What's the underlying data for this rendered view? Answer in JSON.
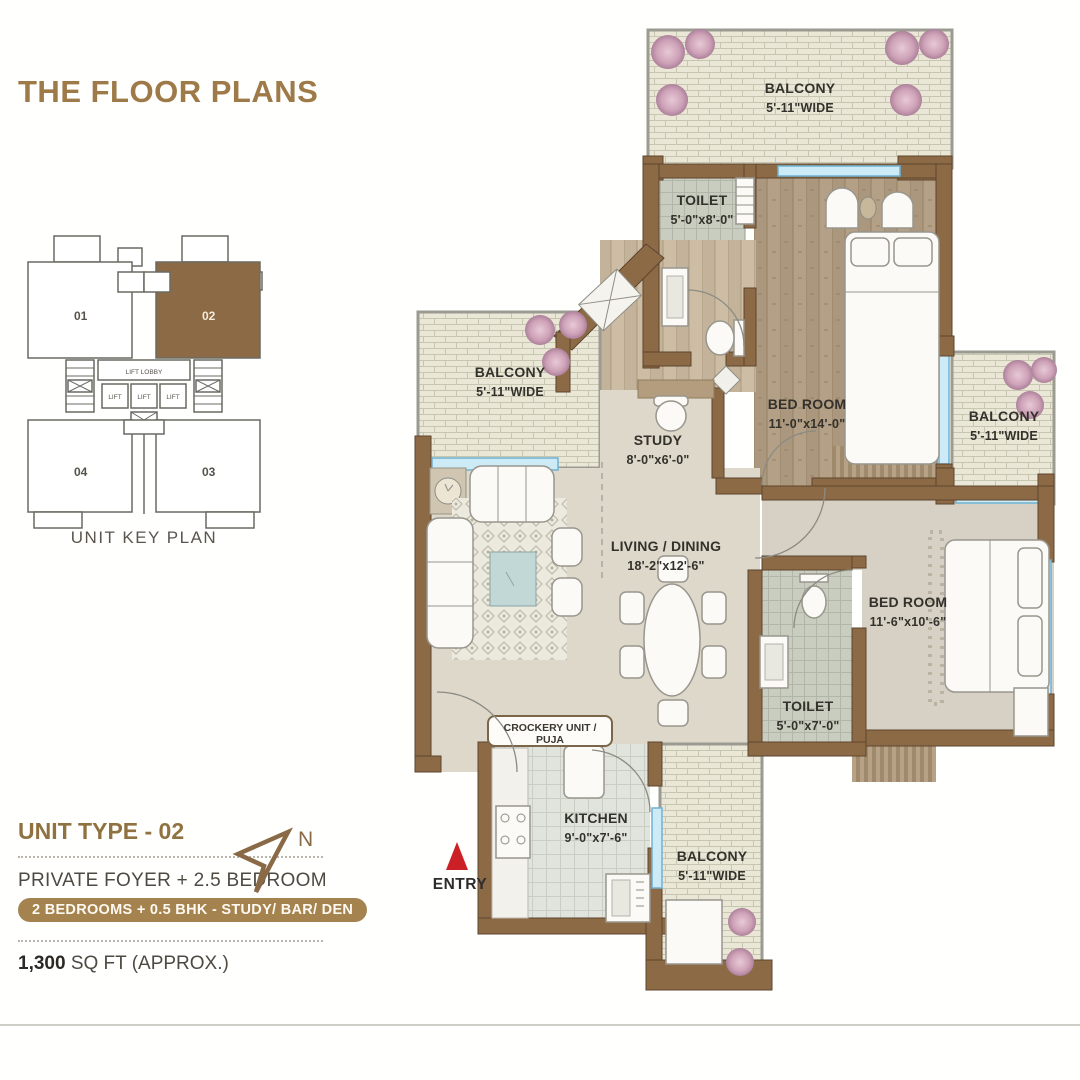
{
  "page": {
    "title": "THE FLOOR PLANS",
    "key_plan_caption": "UNIT KEY PLAN",
    "unit_type": "UNIT TYPE - 02",
    "subtitle": "PRIVATE FOYER + 2.5 BEDROOM",
    "badge": "2 BEDROOMS + 0.5 BHK - STUDY/ BAR/ DEN",
    "area_value": "1,300",
    "area_suffix": " SQ FT (APPROX.)",
    "north_label": "N",
    "entry_label": "ENTRY"
  },
  "key_plan": {
    "u1": "01",
    "u2": "02",
    "u3": "03",
    "u4": "04",
    "lift_lobby": "LIFT LOBBY",
    "lift": "LIFT",
    "highlighted_unit": "02"
  },
  "rooms": [
    {
      "name": "BALCONY",
      "dims": "5'-11\"WIDE"
    },
    {
      "name": "TOILET",
      "dims": "5'-0\"x8'-0\""
    },
    {
      "name": "BED ROOM",
      "dims": "11'-0\"x14'-0\""
    },
    {
      "name": "BALCONY",
      "dims": "5'-11\"WIDE"
    },
    {
      "name": "BALCONY",
      "dims": "5'-11\"WIDE"
    },
    {
      "name": "STUDY",
      "dims": "8'-0\"x6'-0\""
    },
    {
      "name": "LIVING / DINING",
      "dims": "18'-2\"x12'-6\""
    },
    {
      "name": "BED ROOM",
      "dims": "11'-6\"x10'-6\""
    },
    {
      "name": "TOILET",
      "dims": "5'-0\"x7'-0\""
    },
    {
      "name": "KITCHEN",
      "dims": "9'-0\"x7'-6\""
    },
    {
      "name": "BALCONY",
      "dims": "5'-11\"WIDE"
    }
  ],
  "labels": {
    "crockery": "CROCKERY UNIT / PUJA"
  },
  "colors": {
    "accent_brown": "#9d7a47",
    "wall_brown": "#8d6a46",
    "badge_brown": "#a5834f",
    "entry_red": "#cc2027",
    "window_blue": "#cdeaf7"
  }
}
